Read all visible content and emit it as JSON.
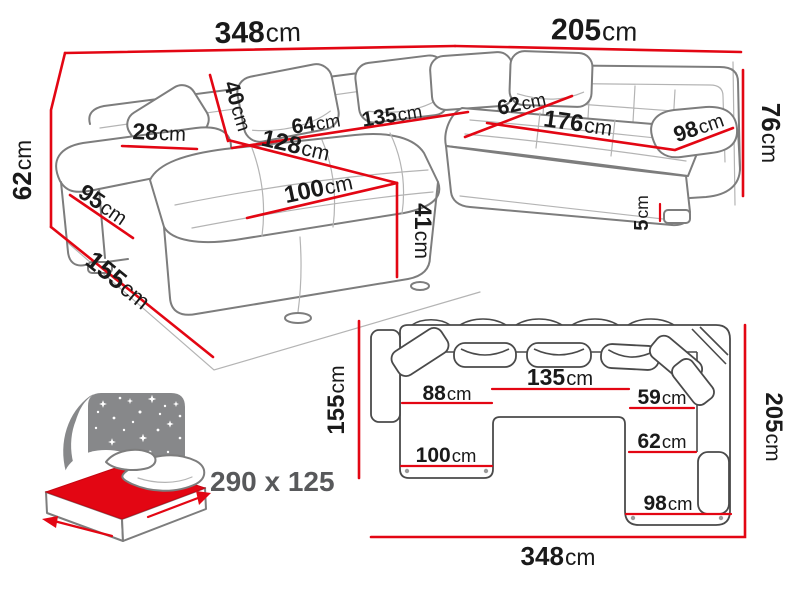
{
  "colors": {
    "dimension_red": "#e30613",
    "outline_gray": "#7d7d7d",
    "plan_outline_gray": "#4a4a4a",
    "icon_gray": "#87888a",
    "label_black": "#1a1a1a",
    "label_gray": "#58595b"
  },
  "perspective_view": {
    "dimensions": [
      {
        "id": "total-width",
        "value": "348",
        "unit": "cm"
      },
      {
        "id": "right-side-length",
        "value": "205",
        "unit": "cm"
      },
      {
        "id": "backrest-height",
        "value": "76",
        "unit": "cm"
      },
      {
        "id": "leg-height",
        "value": "5",
        "unit": "cm"
      },
      {
        "id": "right-seat-depth",
        "value": "98",
        "unit": "cm"
      },
      {
        "id": "right-seat-length",
        "value": "176",
        "unit": "cm"
      },
      {
        "id": "corner-seat-width",
        "value": "62",
        "unit": "cm"
      },
      {
        "id": "middle-seat-width",
        "value": "135",
        "unit": "cm"
      },
      {
        "id": "left-seat-width",
        "value": "64",
        "unit": "cm"
      },
      {
        "id": "backrest-cushion-height",
        "value": "40",
        "unit": "cm"
      },
      {
        "id": "chaise-seat-length",
        "value": "128",
        "unit": "cm"
      },
      {
        "id": "chaise-seat-width",
        "value": "100",
        "unit": "cm"
      },
      {
        "id": "seat-height",
        "value": "41",
        "unit": "cm"
      },
      {
        "id": "armrest-width",
        "value": "28",
        "unit": "cm"
      },
      {
        "id": "armrest-length",
        "value": "95",
        "unit": "cm"
      },
      {
        "id": "armrest-height",
        "value": "62",
        "unit": "cm"
      },
      {
        "id": "chaise-total-depth",
        "value": "155",
        "unit": "cm"
      }
    ]
  },
  "plan_view": {
    "dimensions": [
      {
        "id": "plan-left-depth",
        "value": "155",
        "unit": "cm"
      },
      {
        "id": "plan-right-depth",
        "value": "205",
        "unit": "cm"
      },
      {
        "id": "plan-total-width",
        "value": "348",
        "unit": "cm"
      },
      {
        "id": "plan-chaise-seat-width",
        "value": "88",
        "unit": "cm"
      },
      {
        "id": "plan-middle-seat-width",
        "value": "135",
        "unit": "cm"
      },
      {
        "id": "plan-right-upper-seat-width",
        "value": "59",
        "unit": "cm"
      },
      {
        "id": "plan-right-seat-width",
        "value": "62",
        "unit": "cm"
      },
      {
        "id": "plan-chaise-width",
        "value": "100",
        "unit": "cm"
      },
      {
        "id": "plan-right-end-width",
        "value": "98",
        "unit": "cm"
      }
    ]
  },
  "sleeping_function": {
    "bed_size_label": "290 x 125"
  }
}
